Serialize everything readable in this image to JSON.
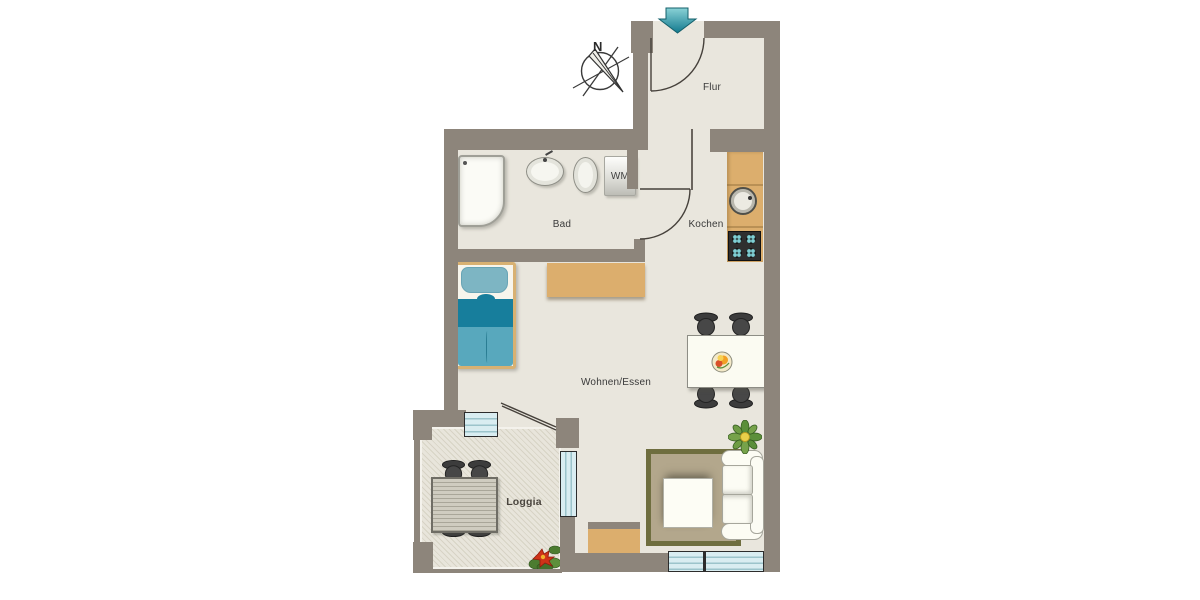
{
  "compass": {
    "north": "N"
  },
  "rooms": {
    "flur": {
      "label": "Flur"
    },
    "bad": {
      "label": "Bad"
    },
    "kochen": {
      "label": "Kochen"
    },
    "wohnen_essen": {
      "label": "Wohnen/Essen"
    },
    "loggia": {
      "label": "Loggia"
    }
  },
  "appliances": {
    "washing_machine_label": "WM"
  },
  "palette": {
    "wall": "#8d857b",
    "floor": "#e9e6dd",
    "wood": "#dcae6d",
    "bed_teal_dark": "#177e9c",
    "bed_teal_light": "#58a8bd",
    "window_blue": "#d9edf1",
    "rug_fill": "#b3a78c",
    "rug_border": "#6f6e3f",
    "chair_dark": "#3c3c3c",
    "entrance_arrow_teal": "#2d96a6"
  }
}
